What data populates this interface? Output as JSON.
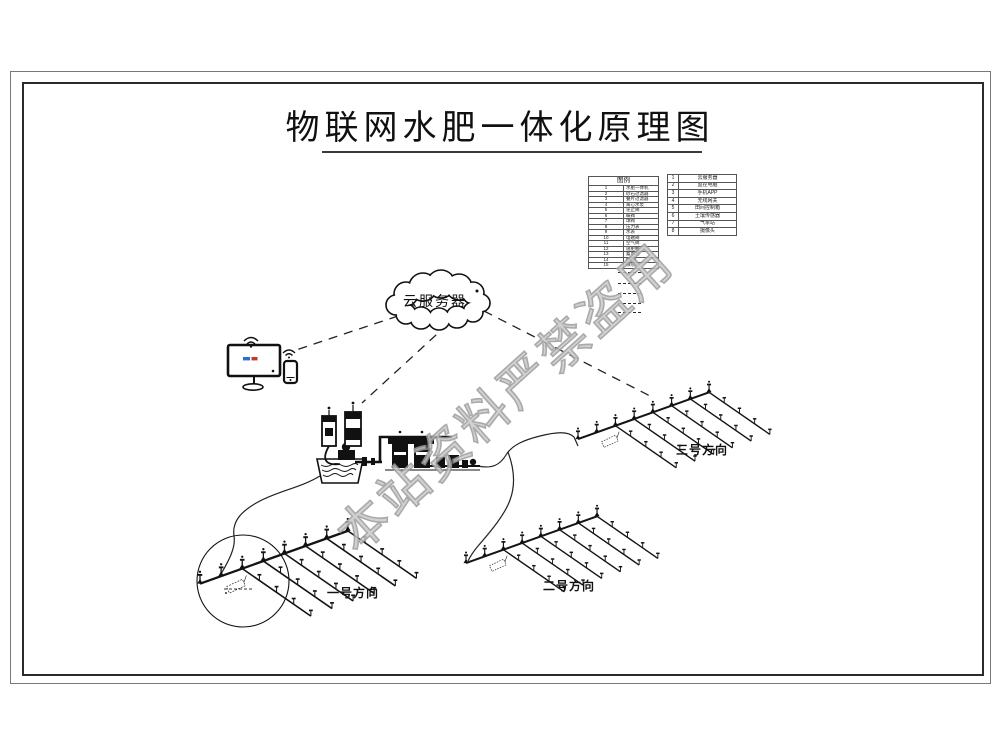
{
  "page": {
    "title": "物联网水肥一体化原理图"
  },
  "watermark": {
    "text": "本站资料严禁盗用"
  },
  "cloud": {
    "label": "云服务器"
  },
  "legend_main": {
    "title": "图例",
    "rows": [
      [
        "1",
        "水肥一体机"
      ],
      [
        "2",
        "砂石过滤器"
      ],
      [
        "3",
        "叠片过滤器"
      ],
      [
        "4",
        "离心水泵"
      ],
      [
        "5",
        "逆止阀"
      ],
      [
        "6",
        "蝶阀"
      ],
      [
        "7",
        "球阀"
      ],
      [
        "8",
        "压力表"
      ],
      [
        "9",
        "水表"
      ],
      [
        "10",
        "电磁阀"
      ],
      [
        "11",
        "空气阀"
      ],
      [
        "12",
        "施肥桶"
      ],
      [
        "13",
        "蓄水池"
      ],
      [
        "14",
        "PE管"
      ],
      [
        "15",
        "微喷头"
      ]
    ]
  },
  "legend_right": {
    "rows": [
      [
        "1",
        "云服务器"
      ],
      [
        "2",
        "监控电脑"
      ],
      [
        "3",
        "手机APP"
      ],
      [
        "4",
        "无线网关"
      ],
      [
        "5",
        "田间控制箱"
      ],
      [
        "6",
        "土壤传感器"
      ],
      [
        "7",
        "气象站"
      ],
      [
        "8",
        "摄像头"
      ]
    ]
  },
  "fields": [
    {
      "label": "一号方向"
    },
    {
      "label": "二号方向"
    },
    {
      "label": "三号方向"
    }
  ]
}
